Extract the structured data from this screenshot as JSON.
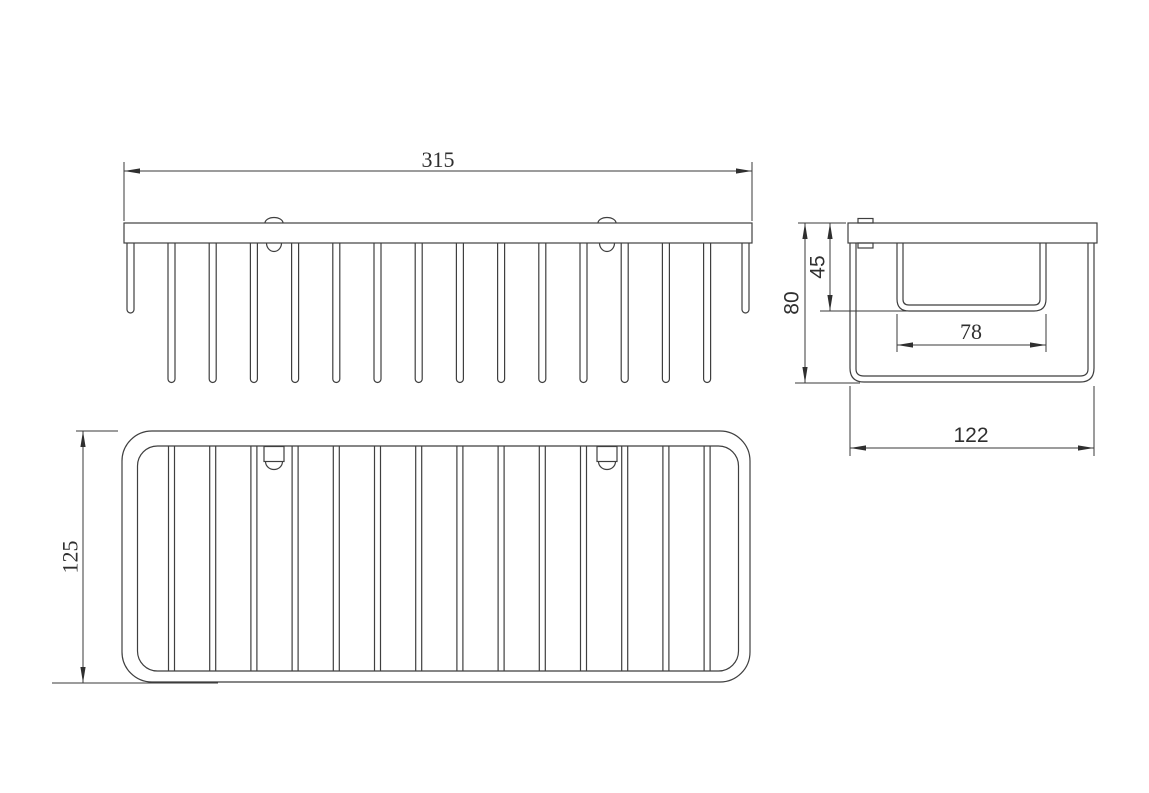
{
  "drawing": {
    "subject": "wire-basket-shelf",
    "views": [
      "front-view",
      "plan-view",
      "side-view"
    ]
  },
  "dimensions": {
    "overall_width": "315",
    "overall_depth": "125",
    "side_overall_height": "80",
    "side_inner_depth": "45",
    "side_inner_width": "78",
    "side_overall_width": "122"
  },
  "colors": {
    "background": "#ffffff",
    "line": "#3f3f3f",
    "dimension_text": "#2f2f2f"
  }
}
